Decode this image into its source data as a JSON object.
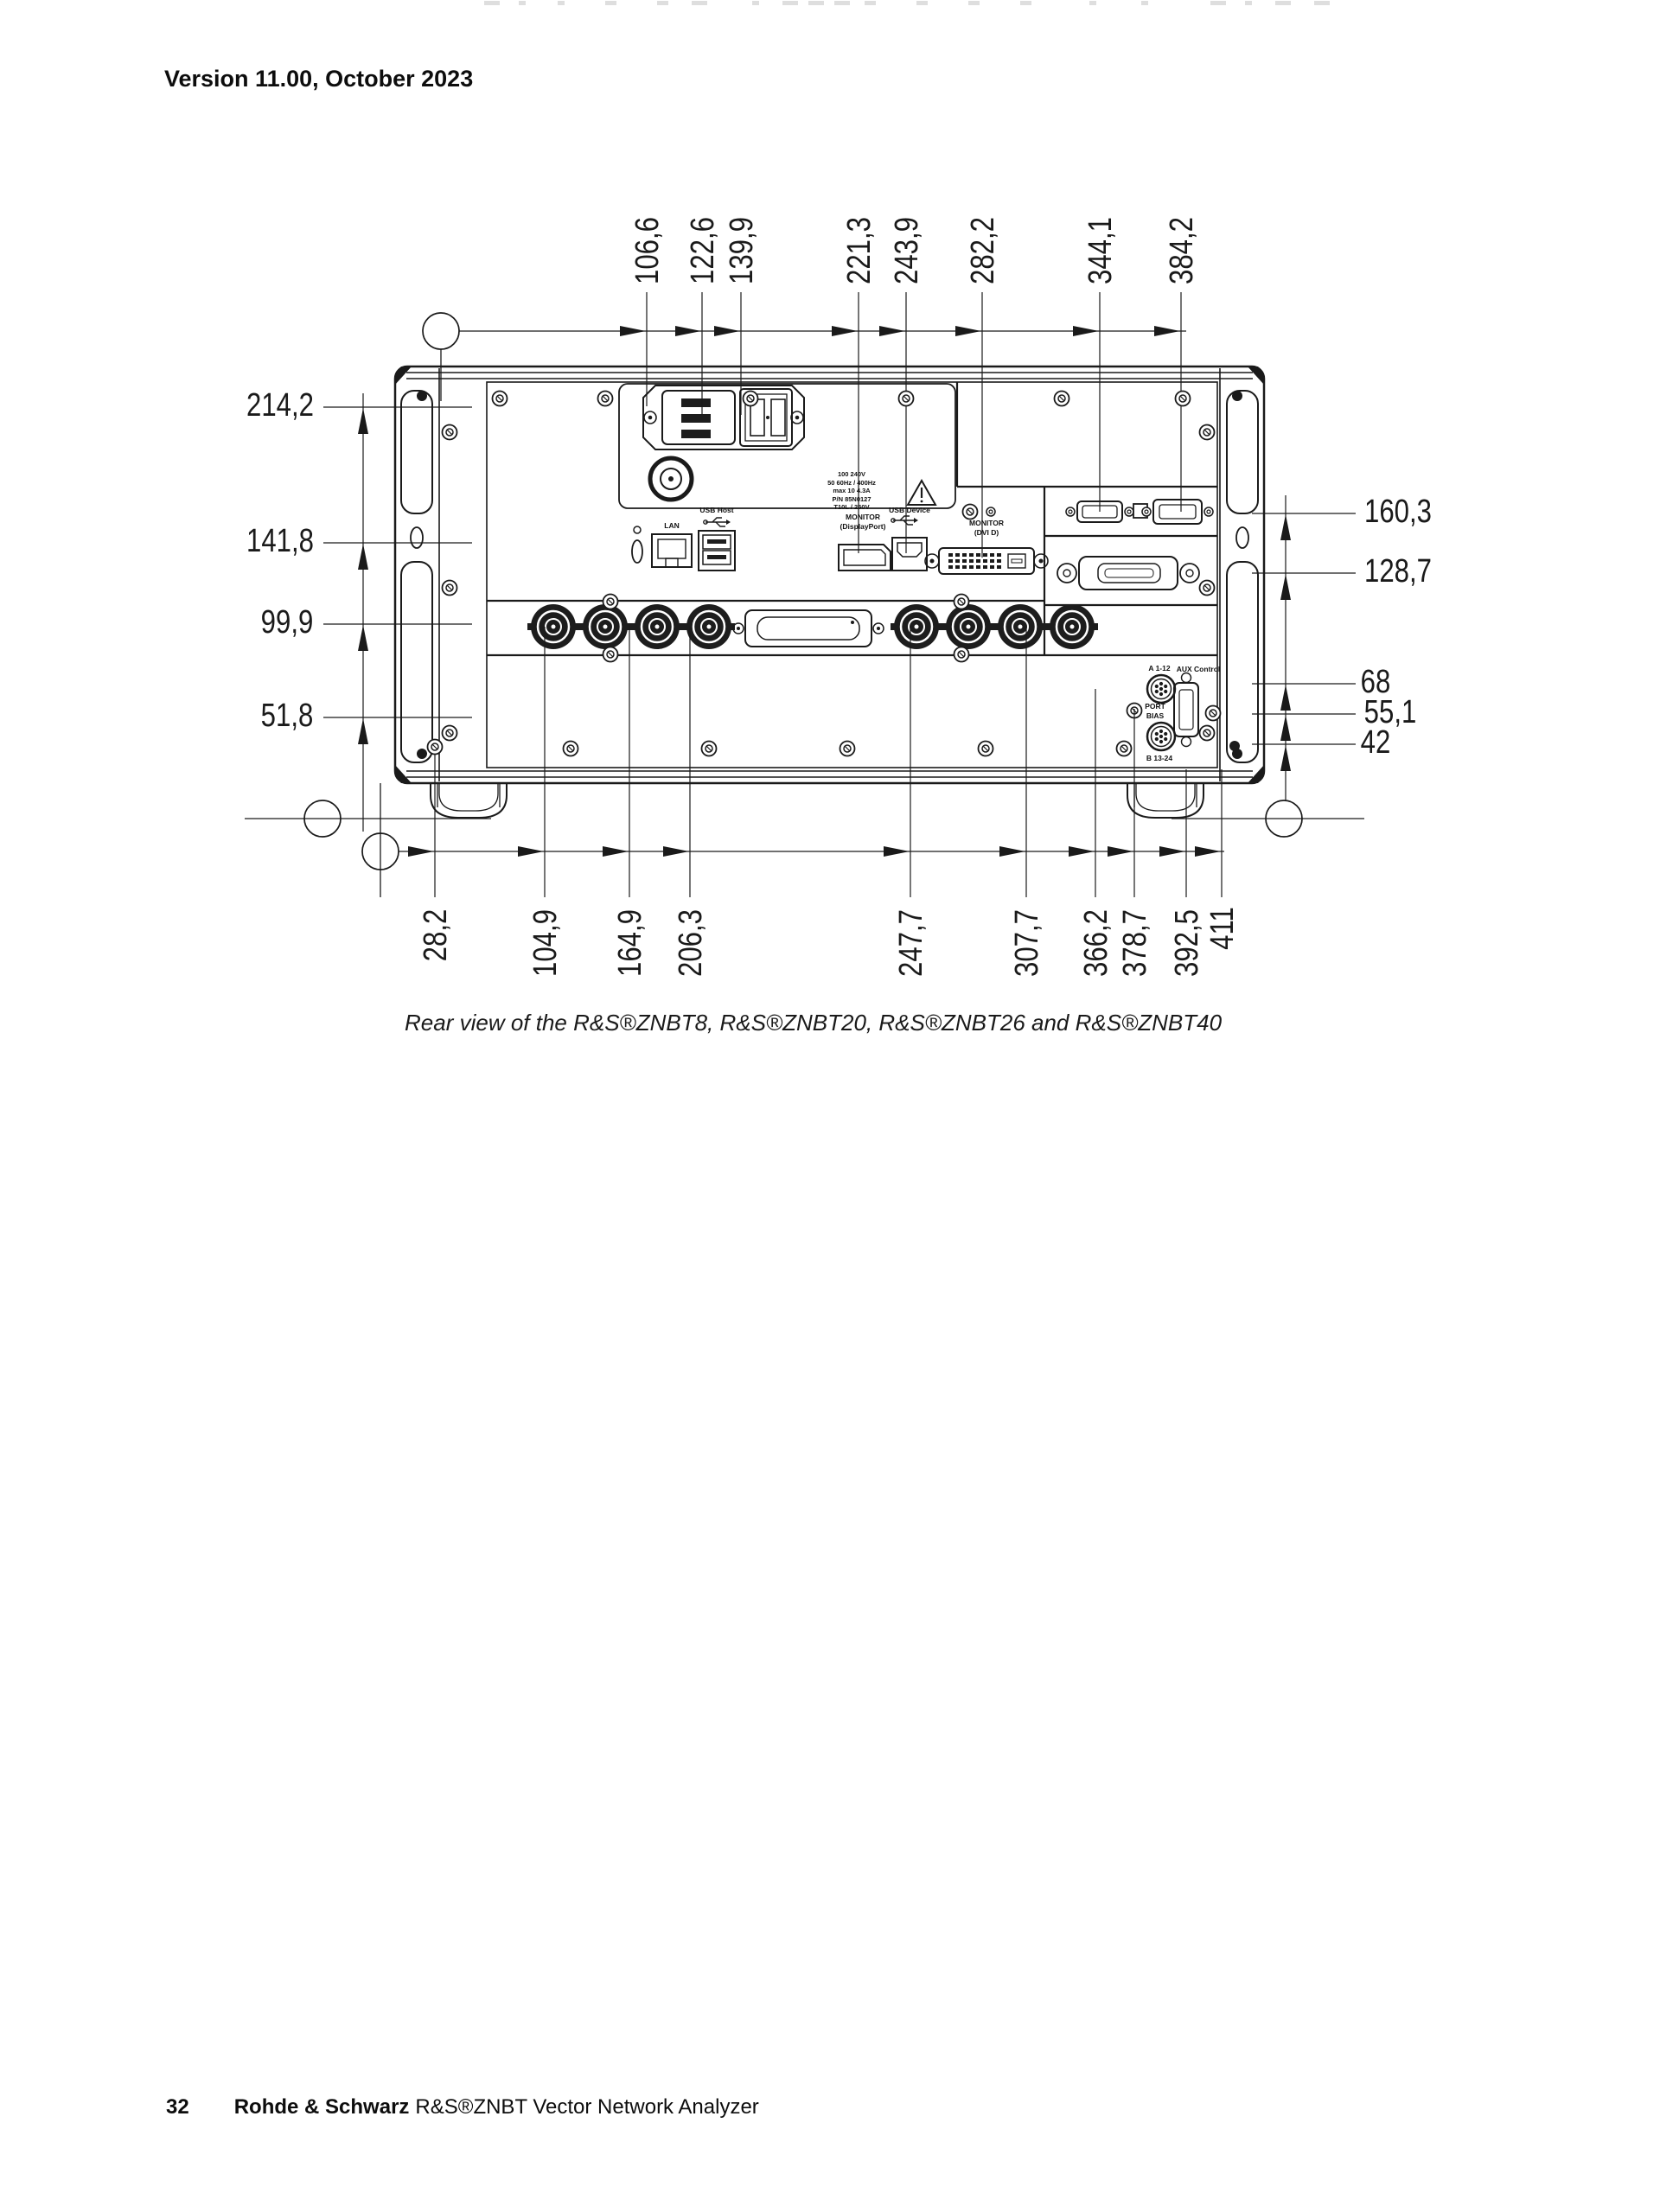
{
  "page": {
    "header": "Version 11.00, October 2023",
    "caption": "Rear view of the R&S®ZNBT8, R&S®ZNBT20, R&S®ZNBT26 and R&S®ZNBT40",
    "footer": {
      "page_number": "32",
      "brand": "Rohde & Schwarz",
      "product": "R&S®ZNBT Vector Network Analyzer"
    }
  },
  "diagram": {
    "dimensions": {
      "top": [
        "106,6",
        "122,6",
        "139,9",
        "221,3",
        "243,9",
        "282,2",
        "344,1",
        "384,2"
      ],
      "bottom": [
        "28,2",
        "104,9",
        "164,9",
        "206,3",
        "247,7",
        "307,7",
        "366,2",
        "378,7",
        "392,5",
        "411"
      ],
      "left": [
        "214,2",
        "141,8",
        "99,9",
        "51,8"
      ],
      "right": [
        "160,3",
        "128,7",
        "68",
        "55,1",
        "42"
      ]
    },
    "connector_labels": {
      "lan": "LAN",
      "usb_host": "USB Host",
      "monitor_dp_line1": "MONITOR",
      "monitor_dp_line2": "(DisplayPort)",
      "usb_device": "USB Device",
      "monitor_dvi_line1": "MONITOR",
      "monitor_dvi_line2": "(DVI D)",
      "a1_12": "A 1-12",
      "aux_control": "AUX Control",
      "port_bias_line1": "PORT",
      "port_bias_line2": "BIAS",
      "b13_24": "B 13-24"
    },
    "power_label_lines": [
      "100 240V",
      "50 60Hz / 400Hz",
      "max 10 4.3A",
      "P/N 85N0127",
      "T10L / 250V"
    ]
  }
}
